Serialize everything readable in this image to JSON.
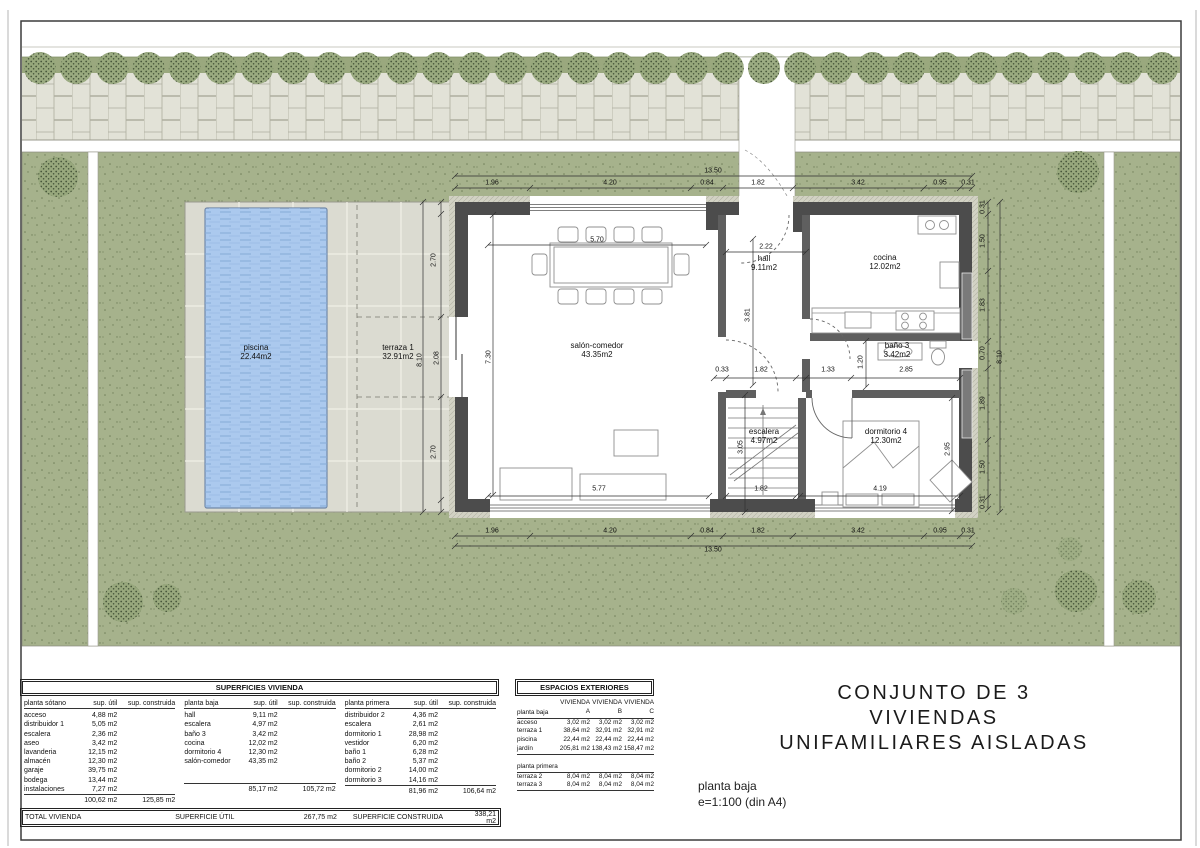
{
  "title_block": {
    "line1": "CONJUNTO DE 3 VIVIENDAS",
    "line2": "UNIFAMILIARES AISLADAS"
  },
  "caption": {
    "line1": "planta baja",
    "line2": "e=1:100 (din A4)"
  },
  "colors": {
    "garden": "#a6b28c",
    "garden_dot": "#71805a",
    "strip_green": "#9aa87e",
    "sidewalk": "#e2e2d7",
    "deck": "#dbdbd1",
    "pool": "#abc9ee",
    "pool_streak": "#86add8",
    "wall": "#4c4c4c",
    "partition": "#5f5f5f",
    "tree": "#97a87c",
    "frame": "#3c3c3c"
  },
  "plan": {
    "room_labels": [
      {
        "lines": [
          "piscina",
          "22.44m2"
        ],
        "x": 256,
        "y": 352
      },
      {
        "lines": [
          "terraza 1",
          "32.91m2"
        ],
        "x": 398,
        "y": 352
      },
      {
        "lines": [
          "salón-comedor",
          "43.35m2"
        ],
        "x": 597,
        "y": 350
      },
      {
        "lines": [
          "hall",
          "9.11m2"
        ],
        "x": 764,
        "y": 263
      },
      {
        "lines": [
          "cocina",
          "12.02m2"
        ],
        "x": 885,
        "y": 262
      },
      {
        "lines": [
          "baño 3",
          "3.42m2"
        ],
        "x": 897,
        "y": 350
      },
      {
        "lines": [
          "escalera",
          "4.97m2"
        ],
        "x": 764,
        "y": 436
      },
      {
        "lines": [
          "dormitorio 4",
          "12.30m2"
        ],
        "x": 886,
        "y": 436
      }
    ],
    "dim_labels": [
      {
        "t": "13.50",
        "x": 713,
        "y": 171
      },
      {
        "t": "1.96",
        "x": 492,
        "y": 183
      },
      {
        "t": "4.20",
        "x": 610,
        "y": 183
      },
      {
        "t": "0.84",
        "x": 707,
        "y": 183
      },
      {
        "t": "1.82",
        "x": 758,
        "y": 183
      },
      {
        "t": "3.42",
        "x": 858,
        "y": 183
      },
      {
        "t": "0.95",
        "x": 940,
        "y": 183
      },
      {
        "t": "0.31",
        "x": 968,
        "y": 183
      },
      {
        "t": "5.70",
        "x": 597,
        "y": 240
      },
      {
        "t": "2.22",
        "x": 766,
        "y": 247
      },
      {
        "t": "7.30",
        "x": 489,
        "y": 357,
        "r": -90
      },
      {
        "t": "3.81",
        "x": 748,
        "y": 315,
        "r": -90
      },
      {
        "t": "2.70",
        "x": 434,
        "y": 260,
        "r": -90
      },
      {
        "t": "8.10",
        "x": 420,
        "y": 360,
        "r": -90
      },
      {
        "t": "2.08",
        "x": 437,
        "y": 358,
        "r": -90
      },
      {
        "t": "2.70",
        "x": 434,
        "y": 452,
        "r": -90
      },
      {
        "t": "0.33",
        "x": 722,
        "y": 370
      },
      {
        "t": "1.82",
        "x": 761,
        "y": 370
      },
      {
        "t": "1.33",
        "x": 828,
        "y": 370
      },
      {
        "t": "1.20",
        "x": 861,
        "y": 362,
        "r": -90
      },
      {
        "t": "2.85",
        "x": 906,
        "y": 370
      },
      {
        "t": "3.05",
        "x": 741,
        "y": 447,
        "r": -90
      },
      {
        "t": "2.95",
        "x": 948,
        "y": 449,
        "r": -90
      },
      {
        "t": "5.77",
        "x": 599,
        "y": 489
      },
      {
        "t": "1.82",
        "x": 761,
        "y": 489
      },
      {
        "t": "4.19",
        "x": 880,
        "y": 489
      },
      {
        "t": "1.96",
        "x": 492,
        "y": 531
      },
      {
        "t": "4.20",
        "x": 610,
        "y": 531
      },
      {
        "t": "0.84",
        "x": 707,
        "y": 531
      },
      {
        "t": "1.82",
        "x": 758,
        "y": 531
      },
      {
        "t": "3.42",
        "x": 858,
        "y": 531
      },
      {
        "t": "0.95",
        "x": 940,
        "y": 531
      },
      {
        "t": "0.31",
        "x": 968,
        "y": 531
      },
      {
        "t": "13.50",
        "x": 713,
        "y": 550
      },
      {
        "t": "0.31",
        "x": 983,
        "y": 207,
        "r": -90
      },
      {
        "t": "1.50",
        "x": 983,
        "y": 241,
        "r": -90
      },
      {
        "t": "1.83",
        "x": 983,
        "y": 305,
        "r": -90
      },
      {
        "t": "0.70",
        "x": 983,
        "y": 353,
        "r": -90
      },
      {
        "t": "1.89",
        "x": 983,
        "y": 403,
        "r": -90
      },
      {
        "t": "1.50",
        "x": 983,
        "y": 467,
        "r": -90
      },
      {
        "t": "0.31",
        "x": 983,
        "y": 502,
        "r": -90
      },
      {
        "t": "8.10",
        "x": 1000,
        "y": 357,
        "r": -90
      }
    ]
  },
  "site": {
    "street_trees": {
      "y": 68,
      "start": 40,
      "step": 36.2,
      "count": 32,
      "r": 16
    },
    "trees": [
      {
        "x": 58,
        "y": 177,
        "r": 20
      },
      {
        "x": 1078,
        "y": 172,
        "r": 21
      },
      {
        "x": 123,
        "y": 602,
        "r": 20
      },
      {
        "x": 167,
        "y": 598,
        "r": 14
      },
      {
        "x": 1076,
        "y": 591,
        "r": 21
      },
      {
        "x": 1139,
        "y": 597,
        "r": 17
      },
      {
        "x": 1014,
        "y": 601,
        "r": 13,
        "light": true
      },
      {
        "x": 1070,
        "y": 549,
        "r": 12,
        "light": true
      }
    ]
  },
  "tables": {
    "superficies": {
      "title": "SUPERFICIES VIVIENDA",
      "col_util": "sup. útil",
      "col_cons": "sup. construida",
      "groups": [
        {
          "name": "planta sótano",
          "rows": [
            [
              "acceso",
              "4,88 m2"
            ],
            [
              "distribuidor 1",
              "5,05 m2"
            ],
            [
              "escalera",
              "2,36 m2"
            ],
            [
              "aseo",
              "3,42 m2"
            ],
            [
              "lavanderia",
              "12,15 m2"
            ],
            [
              "almacén",
              "12,30 m2"
            ],
            [
              "garaje",
              "39,75 m2"
            ],
            [
              "bodega",
              "13,44 m2"
            ],
            [
              "instalaciones",
              "7,27 m2"
            ]
          ],
          "total_util": "100,62 m2",
          "total_cons": "125,85 m2"
        },
        {
          "name": "planta baja",
          "rows": [
            [
              "hall",
              "9,11 m2"
            ],
            [
              "escalera",
              "4,97 m2"
            ],
            [
              "baño 3",
              "3,42 m2"
            ],
            [
              "cocina",
              "12,02 m2"
            ],
            [
              "dormitorio 4",
              "12,30 m2"
            ],
            [
              "salón-comedor",
              "43,35 m2"
            ]
          ],
          "total_util": "85,17 m2",
          "total_cons": "105,72 m2"
        },
        {
          "name": "planta primera",
          "rows": [
            [
              "distribuidor 2",
              "4,36 m2"
            ],
            [
              "escalera",
              "2,61 m2"
            ],
            [
              "dormitorio 1",
              "28,98 m2"
            ],
            [
              "vestidor",
              "6,20 m2"
            ],
            [
              "baño 1",
              "6,28 m2"
            ],
            [
              "baño 2",
              "5,37 m2"
            ],
            [
              "dormitorio 2",
              "14,00 m2"
            ],
            [
              "dormitorio 3",
              "14,16 m2"
            ]
          ],
          "total_util": "81,96 m2",
          "total_cons": "106,64 m2"
        }
      ],
      "total_row": {
        "label": "TOTAL VIVIENDA",
        "util_label": "SUPERFICIE ÚTIL",
        "util_value": "267,75 m2",
        "cons_label": "SUPERFICIE CONSTRUIDA",
        "cons_value": "338,21 m2"
      }
    },
    "exteriores": {
      "title": "ESPACIOS EXTERIORES",
      "col_headers": [
        "VIVIENDA A",
        "VIVIENDA B",
        "VIVIENDA C"
      ],
      "sections": [
        {
          "name": "planta baja",
          "rows": [
            [
              "acceso",
              "3,02 m2",
              "3,02 m2",
              "3,02 m2"
            ],
            [
              "terraza 1",
              "38,64 m2",
              "32,91 m2",
              "32,91 m2"
            ],
            [
              "piscina",
              "22,44 m2",
              "22,44 m2",
              "22,44 m2"
            ],
            [
              "jardín",
              "205,81 m2",
              "138,43 m2",
              "158,47 m2"
            ]
          ]
        },
        {
          "name": "planta primera",
          "rows": [
            [
              "terraza 2",
              "8,04 m2",
              "8,04 m2",
              "8,04 m2"
            ],
            [
              "terraza 3",
              "8,04 m2",
              "8,04 m2",
              "8,04 m2"
            ]
          ]
        }
      ]
    }
  }
}
